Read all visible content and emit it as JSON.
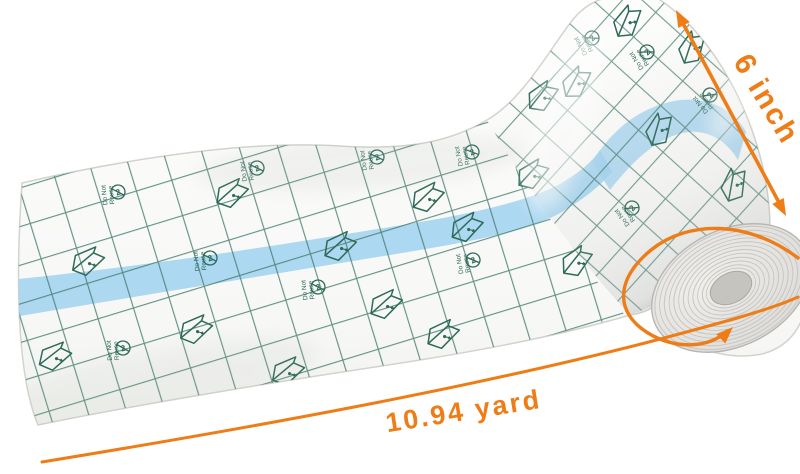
{
  "background_color": "#ffffff",
  "annotations": {
    "width_label": "6 inch",
    "length_label": "10.94 yard",
    "arrow_color": "#ee7d17"
  },
  "liner": {
    "repeat_text": "Do Not Reuse",
    "grid_color": "#3f7869",
    "icon_color": "#2e6a59",
    "stripe_color": "#a4d4f0",
    "icons": [
      "peel-liner-icon",
      "do-not-reuse-icon"
    ]
  },
  "roll": {
    "face_color": "#e7e6e2",
    "ring_color": "#c3c2be",
    "core_color": "#c6c4bf"
  }
}
